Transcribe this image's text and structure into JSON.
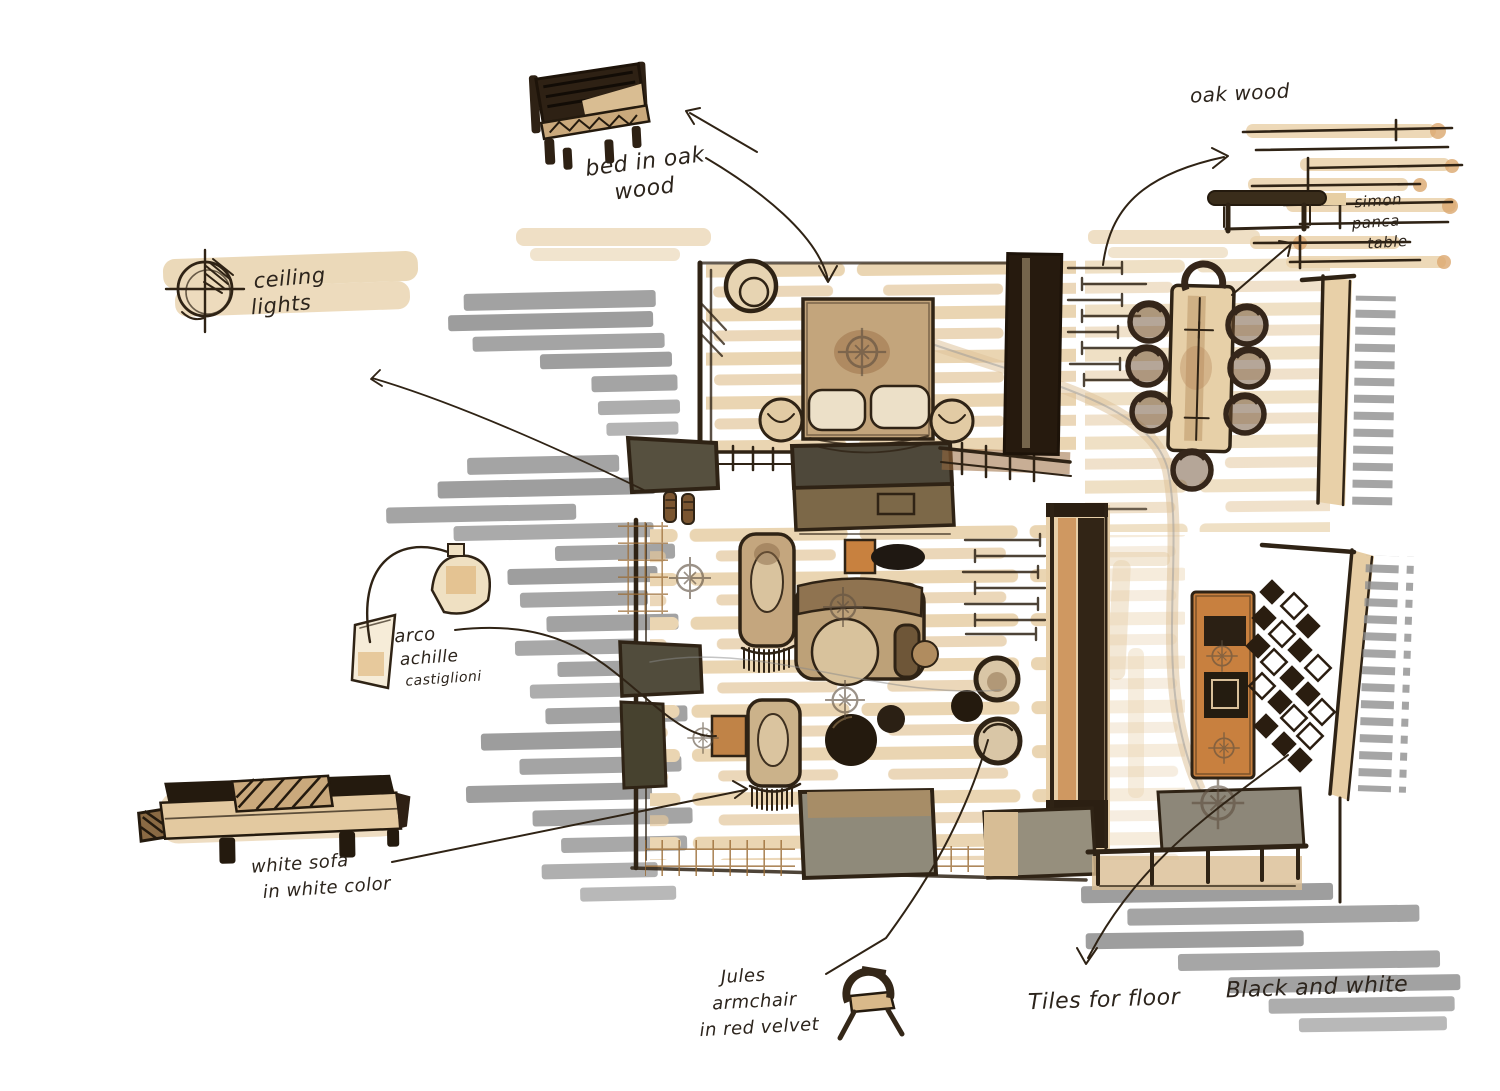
{
  "document": {
    "kind": "hand-drawn interior design floor plan sketch",
    "medium": "ink pen with warm marker rendering and gray marker shadows"
  },
  "colors": {
    "paper": "#ffffff",
    "ink": "#2f2315",
    "ink_dark": "#241a0e",
    "beige_marker": "#ead5b2",
    "tan": "#c3a57c",
    "warm_brown": "#7c6848",
    "orange_brown": "#c8803f",
    "olive_gray": "#56503f",
    "gray_marker": "#8d8d8d",
    "grid_brown": "#9a6a33"
  },
  "annotations": {
    "ceiling_lights": {
      "lines": [
        "ceiling",
        "lights"
      ]
    },
    "bed": {
      "lines": [
        "bed in oak",
        "wood"
      ]
    },
    "oak_wood": {
      "label": "oak wood"
    },
    "bench_table": {
      "lines": [
        "simon",
        "panca",
        "table"
      ]
    },
    "arco": {
      "lines": [
        "arco",
        "achille",
        "castiglioni"
      ]
    },
    "white_sofa": {
      "lines": [
        "white sofa",
        "in white color"
      ]
    },
    "jules": {
      "lines": [
        "Jules",
        "armchair",
        "in red velvet"
      ]
    },
    "tiles": {
      "lines": [
        "Tiles for floor",
        "Black and white"
      ]
    }
  },
  "sketch_elements": [
    "ceiling-light-symbol",
    "bed-perspective-sketch",
    "oak-floor-planks-sketch",
    "bench-table-sketch",
    "arco-floor-lamp-sketch",
    "white-sofa-side-sketch",
    "jules-armchair-sketch",
    "floor-plan-with-bedroom-dining-living",
    "dining-table-with-chairs",
    "double-bed",
    "fringe-settees",
    "round-coffee-tables",
    "wardrobe",
    "desk-unit",
    "diamond-floor-tiles",
    "gray-marker-shadows"
  ]
}
